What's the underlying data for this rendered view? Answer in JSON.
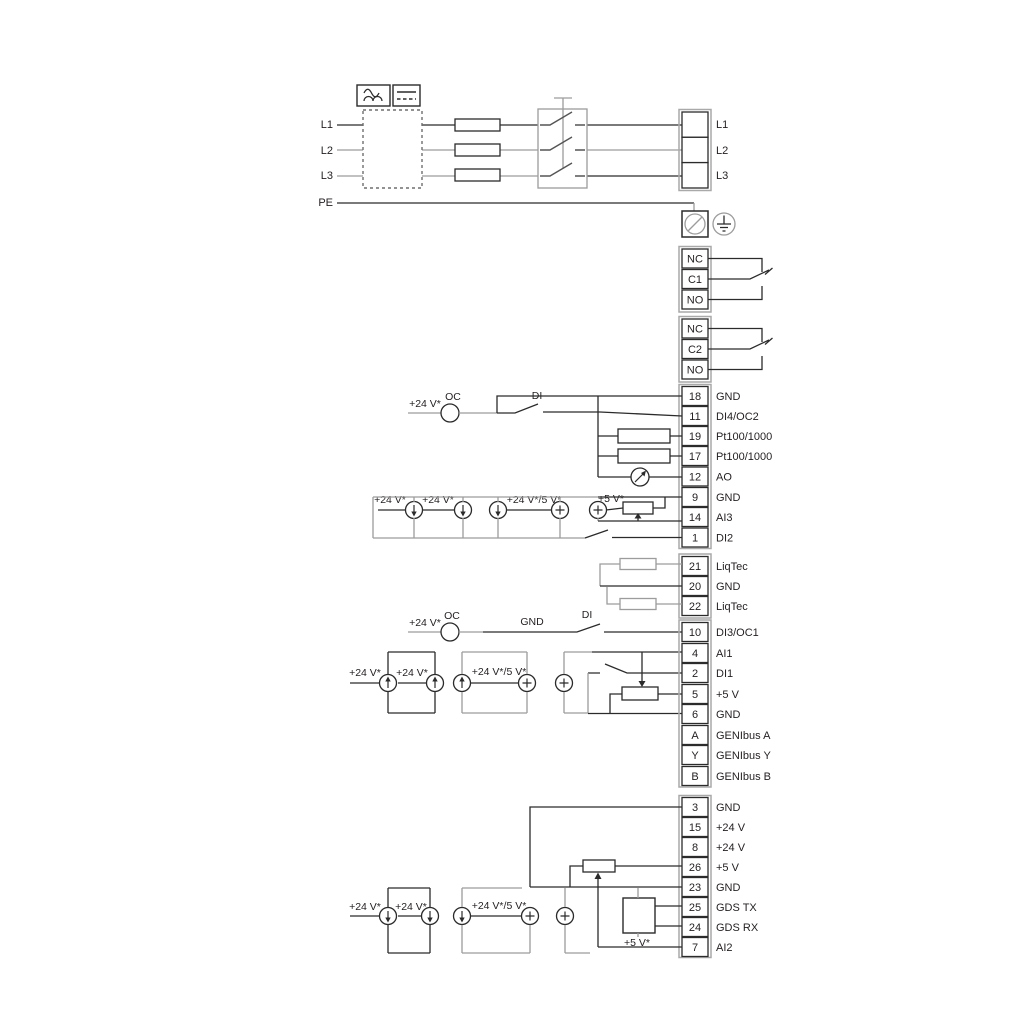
{
  "power": {
    "inputs": [
      "L1",
      "L2",
      "L3",
      "PE"
    ],
    "output_block": [
      "L1",
      "L2",
      "L3"
    ],
    "filter_icons": [
      "ac-wave-icon",
      "dc-line-icon"
    ]
  },
  "relays": {
    "relay1": [
      "NC",
      "C1",
      "NO"
    ],
    "relay2": [
      "NC",
      "C2",
      "NO"
    ]
  },
  "terminals": {
    "io1": [
      {
        "num": "18",
        "label": "GND"
      },
      {
        "num": "11",
        "label": "DI4/OC2"
      },
      {
        "num": "19",
        "label": "Pt100/1000"
      },
      {
        "num": "17",
        "label": "Pt100/1000"
      },
      {
        "num": "12",
        "label": "AO"
      },
      {
        "num": "9",
        "label": "GND"
      },
      {
        "num": "14",
        "label": "AI3"
      },
      {
        "num": "1",
        "label": "DI2"
      }
    ],
    "liqtec": [
      {
        "num": "21",
        "label": "LiqTec"
      },
      {
        "num": "20",
        "label": "GND"
      },
      {
        "num": "22",
        "label": "LiqTec"
      }
    ],
    "io2": [
      {
        "num": "10",
        "label": "DI3/OC1"
      },
      {
        "num": "4",
        "label": "AI1"
      },
      {
        "num": "2",
        "label": "DI1"
      },
      {
        "num": "5",
        "label": "+5 V"
      },
      {
        "num": "6",
        "label": "GND"
      },
      {
        "num": "A",
        "label": "GENIbus A"
      },
      {
        "num": "Y",
        "label": "GENIbus Y"
      },
      {
        "num": "B",
        "label": "GENIbus B"
      }
    ],
    "io3": [
      {
        "num": "3",
        "label": "GND"
      },
      {
        "num": "15",
        "label": "+24 V"
      },
      {
        "num": "8",
        "label": "+24 V"
      },
      {
        "num": "26",
        "label": "+5 V"
      },
      {
        "num": "23",
        "label": "GND"
      },
      {
        "num": "25",
        "label": "GDS TX"
      },
      {
        "num": "24",
        "label": "GDS RX"
      },
      {
        "num": "7",
        "label": "AI2"
      }
    ]
  },
  "annotations": {
    "v24": "+24 V*",
    "v24_5": "+24 V*/5 V*",
    "v5": "+5 V*",
    "oc": "OC",
    "di": "DI",
    "gnd": "GND"
  },
  "colors": {
    "wire_dark": "#2b2b2b",
    "wire_gray": "#9c9c9c",
    "text": "#231f20",
    "background": "#ffffff"
  }
}
